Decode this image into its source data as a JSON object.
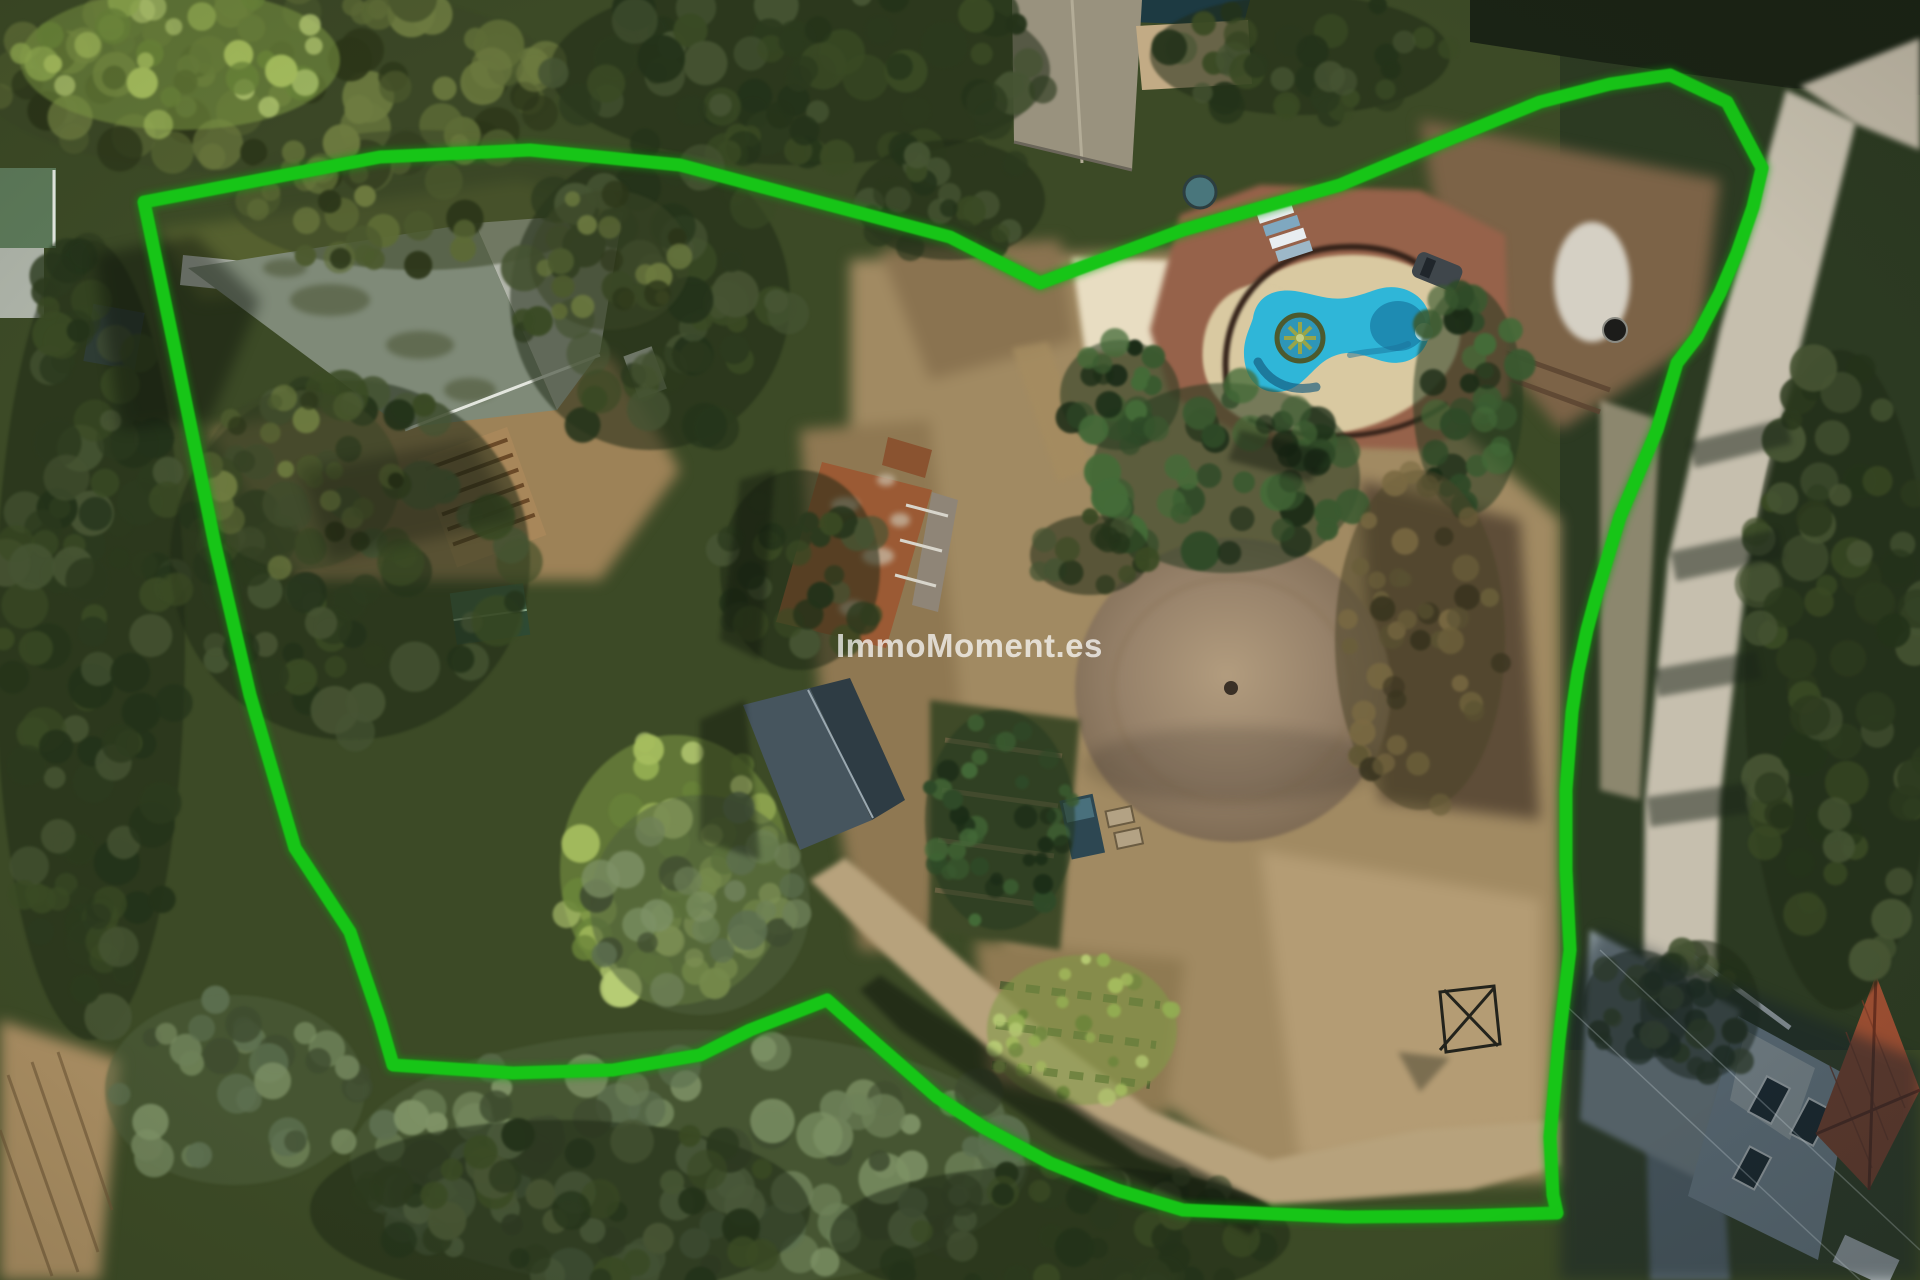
{
  "watermark": {
    "text": "ImmoMoment.es",
    "color": "#ffffff"
  },
  "boundary": {
    "color": "#17c517"
  },
  "pool": {
    "water_color": "#2fb6d8",
    "deep_water_color": "#1d86ae",
    "deck_color": "#d9c9a1",
    "paving_color": "#96624a"
  },
  "scene": {
    "kind": "aerial-drone-photo",
    "subject": "rural property with outlined plot, pool, outbuildings, dirt circle and surrounding trees"
  },
  "colors": {
    "main_roof_dark_pane": "#7f8a78",
    "main_roof_light_pane": "#b2b6ab",
    "rust_roof": "#9b5a34",
    "slate_roof": "#3c4a53",
    "terracotta_roof": "#9b4e32",
    "road": "#c6bfae",
    "dirt": "#a18a62",
    "circle_mound_center": "#b29c7e",
    "circle_mound_edge": "#7a6750"
  }
}
